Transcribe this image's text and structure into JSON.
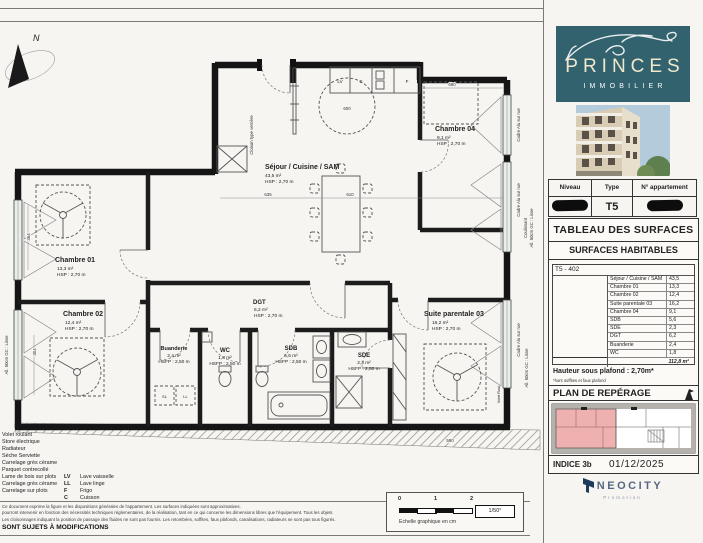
{
  "plan": {
    "compass": "N",
    "rooms": {
      "sejour": {
        "name": "Séjour / Cuisine / SAM",
        "area": "43,5 m²",
        "hsp": "HSP : 2,70 m"
      },
      "ch01": {
        "name": "Chambre 01",
        "area": "13,3 m²",
        "hsp": "HSP : 2,70 m"
      },
      "ch02": {
        "name": "Chambre 02",
        "area": "12,4 m²",
        "hsp": "HSP : 2,70 m"
      },
      "ch04": {
        "name": "Chambre 04",
        "area": "9,1 m²",
        "hsp": "HSP : 2,70 m"
      },
      "suite": {
        "name": "Suite parentale 03",
        "area": "16,2 m²",
        "hsp": "HSP : 2,70 m"
      },
      "dgt": {
        "name": "DGT",
        "area": "6,2 m²",
        "hsp": "HSP : 2,70 m"
      },
      "buanderie": {
        "name": "Buanderie",
        "area": "2,4 m²",
        "hsp": "HSFP : 2,50 m"
      },
      "wc": {
        "name": "WC",
        "area": "1,8 m²",
        "hsp": "HSFP : 2,50 m"
      },
      "sdb": {
        "name": "SDB",
        "area": "5,6 m²",
        "hsp": "HSFP : 2,50 m"
      },
      "sde": {
        "name": "SDE",
        "area": "2,3 m²",
        "hsp": "HSFP : 2,50 m"
      }
    },
    "annotations": {
      "cloison": "Cloison type verrière",
      "cadre_alu": "Cadre Alu sur rue",
      "coulissant": "Coulissant",
      "allege_lisse": "All. 50cm GC : Lisse",
      "volet_roul": "Volet Roul."
    },
    "appliances": {
      "lv": "LV",
      "c": "C",
      "f": "F",
      "sl": "SL",
      "ll": "LL"
    },
    "dims": {
      "w1": "635",
      "w2": "610",
      "w3": "690",
      "w4": "600",
      "w5": "590",
      "h1": "364",
      "h2": "304"
    }
  },
  "legend": {
    "finishes": [
      "Volet roulant",
      "Store électrique",
      "Radiateur",
      "Sèche Serviette",
      "Carrelage grès cérame",
      "Parquet contrecollé",
      "Lame de bois sur plots",
      "Carrelage grès cérame",
      "Carrelage sur plots"
    ],
    "abbrev": [
      {
        "code": "LV",
        "label": "Lave vaisselle"
      },
      {
        "code": "LL",
        "label": "Lave linge"
      },
      {
        "code": "F",
        "label": "Frigo"
      },
      {
        "code": "C",
        "label": "Cuisson"
      }
    ],
    "disclaimer": [
      "Ce document exprime la figure et les dispositions générales de l'appartement. Les surfaces indiquées sont approximatives.",
      "pourront intervenir en fonction des nécessités techniques réglementaires, de la réalisation, tant en ce qui concerne les dimensions libres que l'équipement. Tous les objets",
      "Les cloisonnages indiquant la position de passage des fluides ne sont pas fournis. Les retombées, soffites, faux plafonds, canalisations, radiateurs ne sont pas tous figurés."
    ],
    "warning": "SONT SUJETS À MODIFICATIONS"
  },
  "scalebar": {
    "t0": "0",
    "t1": "1",
    "t2": "2",
    "ratio": "1/50°",
    "caption": "Echelle graphique en cm"
  },
  "sidebar": {
    "brand": {
      "name": "PRINCES",
      "tagline": "IMMOBILIER"
    },
    "info": {
      "headers": [
        "Niveau",
        "Type",
        "N° appartement"
      ],
      "type_value": "T5"
    },
    "surfaces": {
      "title": "TABLEAU DES SURFACES",
      "subtitle": "SURFACES HABITABLES",
      "unit": "T5 - 402",
      "rows": [
        {
          "label": "Séjour / Cuisine / SAM",
          "value": "43,5"
        },
        {
          "label": "Chambre 01",
          "value": "13,3"
        },
        {
          "label": "Chambre 02",
          "value": "12,4"
        },
        {
          "label": "Suite parentale 03",
          "value": "16,2"
        },
        {
          "label": "Chambre 04",
          "value": "9,1"
        },
        {
          "label": "SDB",
          "value": "5,6"
        },
        {
          "label": "SDE",
          "value": "2,3"
        },
        {
          "label": "DGT",
          "value": "6,2"
        },
        {
          "label": "Buanderie",
          "value": "2,4"
        },
        {
          "label": "WC",
          "value": "1,8"
        }
      ],
      "total": "112,8 m²"
    },
    "ceiling": {
      "text": "Hauteur sous plafond : 2,70m*",
      "note": "*hors soffites et faux plafond"
    },
    "reperage": {
      "title": "PLAN DE REPÉRAGE"
    },
    "indice": {
      "label": "INDICE 3b",
      "date": "01/12/2025"
    },
    "promoter": {
      "name": "NEOCITY",
      "sub": "Promotion"
    }
  },
  "colors": {
    "brand_teal": "#33626f",
    "brand_cream": "#efe8cd",
    "highlight_pink": "#eeb1af",
    "neocity_navy": "#1e3a5c"
  }
}
